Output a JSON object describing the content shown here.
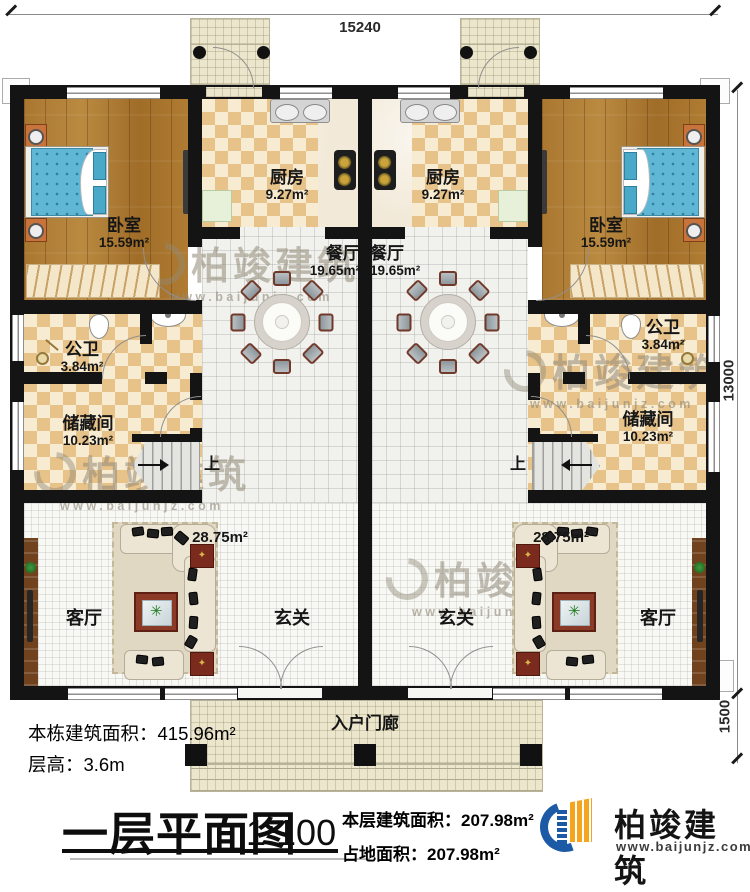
{
  "dimensions": {
    "width_top": "15240",
    "height_right": "13000",
    "porch_depth": "1500"
  },
  "rooms": {
    "bedroom_left": {
      "name": "卧室",
      "area": "15.59m²"
    },
    "bedroom_right": {
      "name": "卧室",
      "area": "15.59m²"
    },
    "kitchen_left": {
      "name": "厨房",
      "area": "9.27m²"
    },
    "kitchen_right": {
      "name": "厨房",
      "area": "9.27m²"
    },
    "dining_left": {
      "name": "餐厅",
      "area": "19.65m²"
    },
    "dining_right": {
      "name": "餐厅",
      "area": "19.65m²"
    },
    "bath_left": {
      "name": "公卫",
      "area": "3.84m²"
    },
    "bath_right": {
      "name": "公卫",
      "area": "3.84m²"
    },
    "storage_left": {
      "name": "储藏间",
      "area": "10.23m²"
    },
    "storage_right": {
      "name": "储藏间",
      "area": "10.23m²"
    },
    "living_left": {
      "name": "客厅",
      "area": "28.75m²"
    },
    "living_right": {
      "name": "客厅",
      "area": "28.75m²"
    },
    "foyer_left": {
      "name": "玄关"
    },
    "foyer_right": {
      "name": "玄关"
    },
    "porch": {
      "name": "入户门廊"
    }
  },
  "stairs": {
    "up_label": "上"
  },
  "notes": {
    "total_area": "本栋建筑面积：415.96m²",
    "floor_height": "层高：3.6m"
  },
  "titleblock": {
    "title": "一层平面图",
    "scale": "1:100",
    "floor_area": "本层建筑面积：207.98m²",
    "footprint_area": "占地面积：207.98m²"
  },
  "logo": {
    "name": "柏竣建筑",
    "url": "www.baijunjz.com"
  },
  "watermark": {
    "text": "柏竣建筑",
    "url": "www.baijunjz.com"
  },
  "colors": {
    "logo_blue": "#1d5aa6",
    "logo_orange": "#f5a41d",
    "wall": "#141414"
  }
}
